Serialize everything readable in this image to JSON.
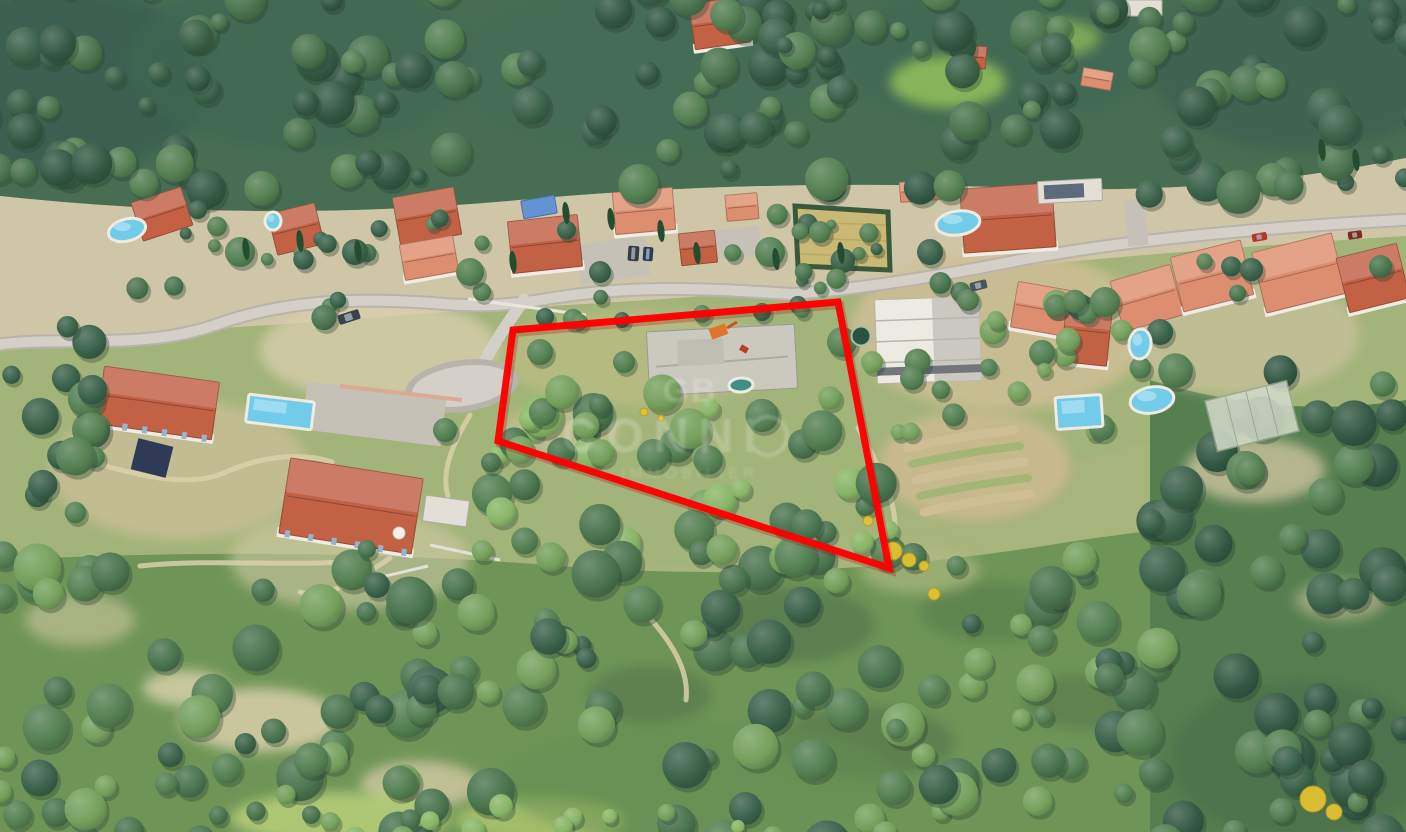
{
  "scene": {
    "width": 1406,
    "height": 832,
    "description": "3D aerial photograph of a wooded hillside residential neighborhood with a building plot outlined in red"
  },
  "palette": {
    "base": "#a3b177",
    "topForest": "#3e684b",
    "band": "#cdc4a4",
    "midSlope": "#9eb274",
    "bottomForest": "#679150",
    "rightForest": "#4d7a48",
    "fd": "#2f5a40",
    "fd2": "#27503a",
    "fm": "#4a7a49",
    "fm2": "#3f6d44",
    "fl": "#6d9c55",
    "cb": "#82b35f",
    "roadFill": "#d2cfc6",
    "roadEdge": "#b5b2a8",
    "dirt": "#d9cfa8",
    "terracotta": "#bf5a3c",
    "salmon": "#dd8a6a",
    "pale": "#e2dfd6",
    "slab": "#c9c7bc",
    "modern": "#eceae2",
    "tarp": "#5b8fd4",
    "wall": "#f0ede3",
    "pool": "#72cbe8",
    "poolDeep": "#3f8f86",
    "hay": "#c8b66f",
    "hedge": "#2f5233",
    "yellow": "#e2c231",
    "red": "#ff0000"
  },
  "terrain": {
    "bands": [
      {
        "d": "M0 0 H1406 V832 H0 Z",
        "fill": "base"
      },
      {
        "d": "M0 0 H1406 V158 Q1220 196 1020 188 Q760 178 520 200 Q260 224 0 196 Z",
        "fill": "topForest"
      },
      {
        "d": "M0 196 Q260 224 520 200 Q760 178 1020 188 Q1220 196 1406 158 V236 Q1150 252 950 274 Q700 300 470 310 Q230 330 0 340 Z",
        "fill": "band"
      },
      {
        "d": "M0 340 Q230 330 470 310 Q700 300 950 274 Q1150 252 1406 236 V400 Q1200 420 1050 470 Q900 520 760 560 Q500 580 300 560 Q140 548 0 560 Z",
        "fill": "midSlope"
      },
      {
        "d": "M0 560 Q300 545 560 566 Q800 585 1050 545 Q1230 515 1406 520 V832 H0 Z",
        "fill": "bottomForest"
      },
      {
        "d": "M1150 380 Q1280 420 1406 400 V832 H1150 Z",
        "fill": "rightForest"
      }
    ],
    "patches": [
      [
        60,
        80,
        150,
        95,
        "#2f5748",
        0.8
      ],
      [
        300,
        62,
        170,
        85,
        "#35604b",
        0.7
      ],
      [
        640,
        70,
        180,
        80,
        "#3a654d",
        0.6
      ],
      [
        1000,
        55,
        160,
        70,
        "#35604b",
        0.6
      ],
      [
        1300,
        65,
        150,
        85,
        "#31594a",
        0.75
      ],
      [
        948,
        82,
        58,
        26,
        "#8abb55",
        0.9
      ],
      [
        1060,
        38,
        40,
        18,
        "#84b553",
        0.8
      ],
      [
        1000,
        330,
        150,
        80,
        "#cdbd93",
        0.85
      ],
      [
        1240,
        335,
        120,
        60,
        "#c9c09c",
        0.7
      ],
      [
        380,
        350,
        120,
        50,
        "#d6cdaa",
        0.8
      ],
      [
        180,
        470,
        130,
        70,
        "#c9bd96",
        0.75
      ],
      [
        350,
        560,
        120,
        50,
        "#cfc8a2",
        0.6
      ],
      [
        640,
        358,
        140,
        48,
        "#b8bb82",
        0.7
      ],
      [
        560,
        430,
        60,
        25,
        "#c9c096",
        0.6
      ],
      [
        260,
        720,
        80,
        32,
        "#d8cfa7",
        0.85
      ],
      [
        420,
        785,
        60,
        24,
        "#d2c8a0",
        0.8
      ],
      [
        185,
        688,
        42,
        18,
        "#dcd3ac",
        0.8
      ],
      [
        340,
        818,
        110,
        26,
        "#b0cc72",
        0.9
      ],
      [
        540,
        820,
        85,
        22,
        "#a8c468",
        0.85
      ],
      [
        790,
        625,
        85,
        38,
        "#456740",
        0.55
      ],
      [
        650,
        695,
        62,
        30,
        "#456740",
        0.5
      ],
      [
        990,
        612,
        70,
        30,
        "#49703f",
        0.5
      ],
      [
        865,
        742,
        90,
        36,
        "#44663c",
        0.5
      ],
      [
        1085,
        702,
        62,
        28,
        "#44663c",
        0.45
      ],
      [
        975,
        465,
        95,
        55,
        "#c9b88d",
        0.9
      ],
      [
        1255,
        470,
        70,
        32,
        "#cbc29b",
        0.8
      ],
      [
        1340,
        600,
        45,
        20,
        "#c2bb90",
        0.6
      ],
      [
        1300,
        760,
        130,
        80,
        "#3c6640",
        0.6
      ],
      [
        700,
        782,
        200,
        60,
        "#5d8a4b",
        0.5
      ],
      [
        80,
        620,
        55,
        26,
        "#cdc49c",
        0.6
      ],
      [
        920,
        570,
        60,
        24,
        "#b3bc80",
        0.6
      ]
    ],
    "dirt_paths": [
      "M 58 452 C 120 470 182 492 226 472 C 262 456 302 452 332 462",
      "M 390 558 C 352 584 322 600 300 592",
      "M 640 608 C 668 636 690 668 686 700",
      "M 858 428 C 880 468 900 505 894 540",
      "M 140 566 C 220 558 300 568 362 560",
      "M 470 415 C 455 440 440 470 448 496"
    ],
    "terraces": [
      {
        "d": "M 908 448 Q 960 436 1014 430",
        "c": "#cdbd93",
        "w": 9
      },
      {
        "d": "M 912 464 Q 965 452 1020 446",
        "c": "#9fb46f",
        "w": 8
      },
      {
        "d": "M 916 480 Q 970 468 1024 462",
        "c": "#cdbd93",
        "w": 9
      },
      {
        "d": "M 920 496 Q 974 484 1028 478",
        "c": "#9fb46f",
        "w": 8
      },
      {
        "d": "M 924 512 Q 978 500 1030 494",
        "c": "#cdbd93",
        "w": 9
      }
    ],
    "walls": [
      {
        "d": "M 340 386 L 462 400",
        "c": "#d8a88e",
        "w": 4
      },
      {
        "d": "M 468 299 L 586 315",
        "c": "#e9e6de",
        "w": 3
      },
      {
        "d": "M 352 584 L 428 566",
        "c": "#e3e0d6",
        "w": 3
      },
      {
        "d": "M 430 545 L 500 560",
        "c": "#e3e0d6",
        "w": 3
      }
    ]
  },
  "roads": {
    "main": "M -12 346 C 60 334 140 352 218 324 C 280 302 350 297 432 303 C 478 307 508 306 552 298 C 640 284 710 289 792 294 C 860 289 940 276 1020 260 C 1110 243 1230 229 1420 219",
    "branch": "M 524 300 C 508 322 494 344 484 362",
    "stub": "M 1133 243 C 1136 228 1140 215 1144 204",
    "loop": {
      "cx": 462,
      "cy": 386,
      "rx": 57,
      "ry": 26,
      "rot": -8
    },
    "driveways": [
      {
        "x": 578,
        "y": 240,
        "w": 70,
        "h": 40,
        "rot": -8
      },
      {
        "x": 714,
        "y": 228,
        "w": 46,
        "h": 30,
        "rot": -6
      },
      {
        "x": 304,
        "y": 390,
        "w": 140,
        "h": 48,
        "rot": 7
      },
      {
        "x": 1126,
        "y": 200,
        "w": 20,
        "h": 46,
        "rot": -6
      }
    ]
  },
  "buildings": [
    {
      "x": 136,
      "y": 194,
      "w": 52,
      "h": 40,
      "rot": -18,
      "roof": "terracotta"
    },
    {
      "x": 272,
      "y": 208,
      "w": 48,
      "h": 42,
      "rot": -14,
      "roof": "terracotta"
    },
    {
      "x": 396,
      "y": 192,
      "w": 62,
      "h": 48,
      "rot": -10,
      "roof": "terracotta"
    },
    {
      "x": 402,
      "y": 240,
      "w": 54,
      "h": 36,
      "rot": -10,
      "roof": "salmon",
      "wall": 1
    },
    {
      "x": 510,
      "y": 218,
      "w": 70,
      "h": 52,
      "rot": -6,
      "roof": "terracotta",
      "wall": 1
    },
    {
      "x": 614,
      "y": 190,
      "w": 60,
      "h": 42,
      "rot": -5,
      "roof": "salmon",
      "wall": 1
    },
    {
      "x": 726,
      "y": 194,
      "w": 32,
      "h": 26,
      "rot": -5,
      "roof": "salmon"
    },
    {
      "x": 680,
      "y": 232,
      "w": 36,
      "h": 32,
      "rot": -6,
      "roof": "terracotta"
    },
    {
      "x": 962,
      "y": 186,
      "w": 92,
      "h": 64,
      "rot": -4,
      "roof": "terracotta",
      "wall": 1
    },
    {
      "x": 900,
      "y": 181,
      "w": 40,
      "h": 20,
      "rot": -4,
      "roof": "salmon"
    },
    {
      "x": 1038,
      "y": 180,
      "w": 64,
      "h": 22,
      "rot": -3,
      "roof": "pale",
      "solar": 1
    },
    {
      "x": 876,
      "y": 298,
      "w": 104,
      "h": 84,
      "rot": -2,
      "roof": "modern"
    },
    {
      "x": 1014,
      "y": 286,
      "w": 56,
      "h": 46,
      "rot": 10,
      "roof": "salmon",
      "wall": 1
    },
    {
      "x": 1064,
      "y": 298,
      "w": 46,
      "h": 66,
      "rot": 6,
      "roof": "terracotta",
      "wall": 1
    },
    {
      "x": 1116,
      "y": 272,
      "w": 62,
      "h": 52,
      "rot": -16,
      "roof": "salmon"
    },
    {
      "x": 1176,
      "y": 248,
      "w": 72,
      "h": 56,
      "rot": -14,
      "roof": "salmon",
      "wall": 1
    },
    {
      "x": 1258,
      "y": 242,
      "w": 82,
      "h": 62,
      "rot": -14,
      "roof": "salmon",
      "wall": 1
    },
    {
      "x": 1342,
      "y": 250,
      "w": 62,
      "h": 56,
      "rot": -14,
      "roof": "terracotta",
      "wall": 1
    },
    {
      "x": 692,
      "y": 0,
      "w": 56,
      "h": 46,
      "rot": -8,
      "roof": "terracotta",
      "wall": 1
    },
    {
      "x": 1122,
      "y": 0,
      "w": 40,
      "h": 16,
      "rot": 0,
      "roof": "pale"
    },
    {
      "x": 958,
      "y": 46,
      "w": 28,
      "h": 22,
      "rot": 4,
      "roof": "terracotta"
    },
    {
      "x": 1082,
      "y": 70,
      "w": 30,
      "h": 18,
      "rot": 10,
      "roof": "salmon"
    },
    {
      "x": 100,
      "y": 374,
      "w": 116,
      "h": 58,
      "rot": 8,
      "roof": "terracotta",
      "wall": 1,
      "shutters": 1
    },
    {
      "x": 284,
      "y": 468,
      "w": 134,
      "h": 76,
      "rot": 9,
      "roof": "terracotta",
      "wall": 1,
      "shutters": 1
    },
    {
      "x": 648,
      "y": 328,
      "w": 148,
      "h": 64,
      "rot": -3,
      "roof": "slab"
    },
    {
      "x": 424,
      "y": 498,
      "w": 44,
      "h": 26,
      "rot": 8,
      "roof": "pale"
    },
    {
      "x": 522,
      "y": 198,
      "w": 34,
      "h": 18,
      "rot": -10,
      "roof": "tarp"
    }
  ],
  "pools": [
    {
      "cx": 127,
      "cy": 230,
      "rx": 19,
      "ry": 11,
      "rot": -15
    },
    {
      "cx": 273,
      "cy": 221,
      "rx": 8,
      "ry": 9,
      "rot": 0
    },
    {
      "rect": 1,
      "x": 247,
      "y": 398,
      "w": 66,
      "h": 28,
      "rot": 7
    },
    {
      "cx": 958,
      "cy": 223,
      "rx": 22,
      "ry": 12,
      "rot": -8
    },
    {
      "rect": 1,
      "x": 1056,
      "y": 396,
      "w": 46,
      "h": 32,
      "rot": -4
    },
    {
      "cx": 1152,
      "cy": 400,
      "rx": 22,
      "ry": 13,
      "rot": -10
    },
    {
      "cx": 1140,
      "cy": 344,
      "rx": 11,
      "ry": 15,
      "rot": 6
    },
    {
      "cx": 741,
      "cy": 385,
      "rx": 12,
      "ry": 7,
      "rot": -4,
      "deep": 1
    }
  ],
  "cars": [
    {
      "x": 1252,
      "y": 233,
      "w": 15,
      "h": 8,
      "rot": -10,
      "c": "#b8352c"
    },
    {
      "x": 1348,
      "y": 231,
      "w": 14,
      "h": 8,
      "rot": -8,
      "c": "#7e2a20"
    },
    {
      "x": 970,
      "y": 281,
      "w": 17,
      "h": 9,
      "rot": -14,
      "c": "#4a545c"
    },
    {
      "x": 628,
      "y": 246,
      "w": 11,
      "h": 15,
      "rot": 4,
      "c": "#333a40"
    },
    {
      "x": 643,
      "y": 247,
      "w": 10,
      "h": 14,
      "rot": 4,
      "c": "#2b3a55"
    },
    {
      "x": 338,
      "y": 312,
      "w": 22,
      "h": 10,
      "rot": -18,
      "c": "#39424d"
    }
  ],
  "features": {
    "hay_field": {
      "points": "795,206 888,212 890,270 798,266"
    },
    "tank": {
      "cx": 861,
      "cy": 336,
      "r": 9.5
    },
    "navy_tarp": {
      "x": 134,
      "y": 442,
      "w": 36,
      "h": 32,
      "rot": 14
    },
    "greenhouse": {
      "x": 1210,
      "y": 390,
      "w": 84,
      "h": 52,
      "rot": -14
    },
    "parasol": {
      "cx": 399,
      "cy": 533,
      "r": 6
    },
    "digger": {
      "x": 710,
      "y": 326,
      "w": 17,
      "h": 11,
      "rot": -20
    },
    "roof_mark": {
      "x": 740,
      "y": 346,
      "w": 8,
      "h": 6,
      "rot": 30
    },
    "yellow_bushes": [
      [
        893,
        551,
        9
      ],
      [
        909,
        560,
        7
      ],
      [
        934,
        594,
        6
      ],
      [
        1313,
        799,
        13
      ],
      [
        1334,
        812,
        8
      ],
      [
        868,
        521,
        5
      ],
      [
        644,
        412,
        4
      ],
      [
        661,
        418,
        3
      ],
      [
        924,
        566,
        5
      ]
    ],
    "cypresses": [
      [
        246,
        249
      ],
      [
        300,
        241
      ],
      [
        358,
        251
      ],
      [
        513,
        262
      ],
      [
        566,
        213
      ],
      [
        611,
        219
      ],
      [
        661,
        231
      ],
      [
        697,
        253
      ],
      [
        776,
        259
      ],
      [
        841,
        253
      ],
      [
        1322,
        150
      ],
      [
        1356,
        160
      ]
    ]
  },
  "forest": {
    "seed": 20240613,
    "zones": [
      {
        "x": -20,
        "y": -15,
        "w": 1446,
        "h": 210,
        "n": 160,
        "r0": 8,
        "r1": 22,
        "cols": [
          "fd",
          "fm",
          "fd2",
          "fm2"
        ]
      },
      {
        "x": 160,
        "y": 208,
        "w": 760,
        "h": 46,
        "n": 20,
        "r0": 5,
        "r1": 11,
        "cols": [
          "fm",
          "fd"
        ]
      },
      {
        "x": 120,
        "y": 252,
        "w": 1286,
        "h": 70,
        "n": 26,
        "r0": 6,
        "r1": 13,
        "cols": [
          "fm",
          "fd",
          "fm2"
        ]
      },
      {
        "x": 0,
        "y": 300,
        "w": 95,
        "h": 300,
        "n": 20,
        "r0": 9,
        "r1": 20,
        "cols": [
          "fd",
          "fm"
        ]
      },
      {
        "x": 490,
        "y": 392,
        "w": 400,
        "h": 170,
        "n": 46,
        "r0": 9,
        "r1": 21,
        "cols": [
          "fm",
          "fl",
          "fm2",
          "cb"
        ]
      },
      {
        "x": 880,
        "y": 300,
        "w": 270,
        "h": 140,
        "n": 20,
        "r0": 7,
        "r1": 14,
        "cols": [
          "fm",
          "fl"
        ]
      },
      {
        "x": 1150,
        "y": 370,
        "w": 260,
        "h": 470,
        "n": 55,
        "r0": 10,
        "r1": 24,
        "cols": [
          "fd",
          "fm",
          "fd2"
        ]
      },
      {
        "x": -10,
        "y": 545,
        "w": 1180,
        "h": 300,
        "n": 150,
        "r0": 9,
        "r1": 24,
        "cols": [
          "fm",
          "fd",
          "fl",
          "fm2"
        ]
      },
      {
        "x": 300,
        "y": 800,
        "w": 500,
        "h": 40,
        "n": 12,
        "r0": 6,
        "r1": 12,
        "cols": [
          "fl",
          "cb"
        ]
      }
    ],
    "accents": [
      [
        240,
        252,
        15,
        "fm"
      ],
      [
        355,
        252,
        13,
        "fd"
      ],
      [
        470,
        272,
        14,
        "fm"
      ],
      [
        600,
        272,
        11,
        "fd"
      ],
      [
        770,
        252,
        15,
        "fm"
      ],
      [
        930,
        252,
        13,
        "fd"
      ],
      [
        1105,
        302,
        15,
        "fm"
      ],
      [
        1160,
        332,
        13,
        "fd"
      ],
      [
        820,
        232,
        11,
        "fm"
      ],
      [
        545,
        317,
        9,
        "fd"
      ],
      [
        580,
        322,
        8,
        "fm"
      ],
      [
        622,
        320,
        8,
        "fd"
      ],
      [
        702,
        314,
        9,
        "fm"
      ],
      [
        762,
        312,
        9,
        "fd"
      ],
      [
        802,
        310,
        8,
        "fm"
      ],
      [
        540,
        352,
        13,
        "fm"
      ],
      [
        562,
        392,
        17,
        "fl"
      ],
      [
        624,
        362,
        11,
        "fm"
      ],
      [
        842,
        342,
        15,
        "fm"
      ],
      [
        872,
        362,
        11,
        "fl"
      ],
      [
        912,
        378,
        12,
        "fm"
      ],
      [
        968,
        300,
        11,
        "fm"
      ],
      [
        996,
        320,
        9,
        "fl"
      ],
      [
        445,
        430,
        12,
        "fm"
      ],
      [
        520,
        450,
        14,
        "fl"
      ]
    ]
  },
  "parcel": {
    "points": "513,330 838,302 889,568 498,441",
    "color": "#ff0000",
    "stroke_width": 7
  },
  "watermark": {
    "monogram": "GB",
    "title": "CONNI",
    "subtitle": "IMMOBILIER",
    "color": "#ffffff",
    "opacity": 0.2
  }
}
